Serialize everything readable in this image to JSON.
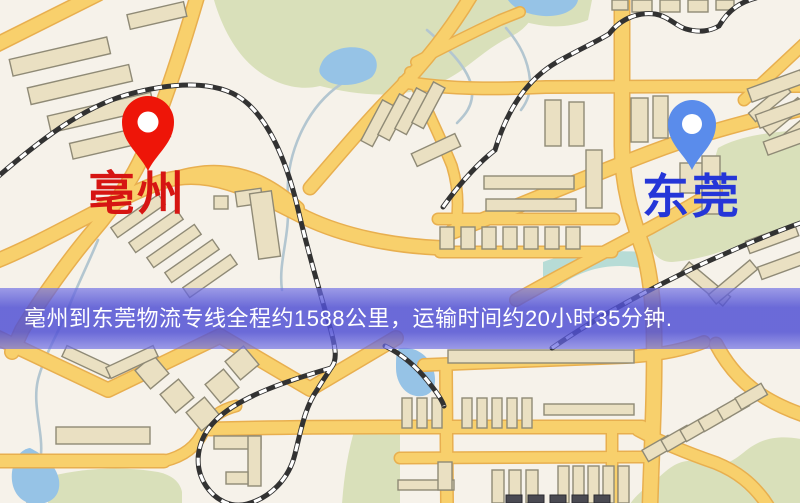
{
  "banner": {
    "text": "亳州到东莞物流专线全程约1588公里，运输时间约20小时35分钟."
  },
  "markers": {
    "origin": {
      "label": "亳州",
      "icon": "map-pin-icon",
      "pin_color": "#ee1508",
      "label_color": "#d61512"
    },
    "destination": {
      "label": "东莞",
      "icon": "map-pin-icon",
      "pin_color": "#5a8ceb",
      "label_color": "#2536d8"
    }
  },
  "route": {
    "from": "亳州",
    "to": "东莞",
    "distance_km": "1588",
    "duration": "20小时35分钟"
  },
  "theme": {
    "map_bg": "#f6f2ea",
    "road_fill": "#f8d06c",
    "road_edge": "#e8af4f",
    "building_fill": "#eae0c2",
    "building_edge": "#8f8a76",
    "building_dark": "#4a4a52",
    "park": "#d9e0ba",
    "water": "#96c3e6",
    "teal": "#b7dcd6",
    "stream": "#b3c6d0",
    "rail_dark": "#323232",
    "banner_top": "rgba(113,113,229,0.68)",
    "banner_mid": "rgba(80,80,212,0.84)",
    "pin_red": "#ee1508",
    "pin_blue": "#5a8ceb",
    "label_red": "#d61512",
    "label_blue": "#2536d8",
    "banner_text": "#ffffff"
  }
}
